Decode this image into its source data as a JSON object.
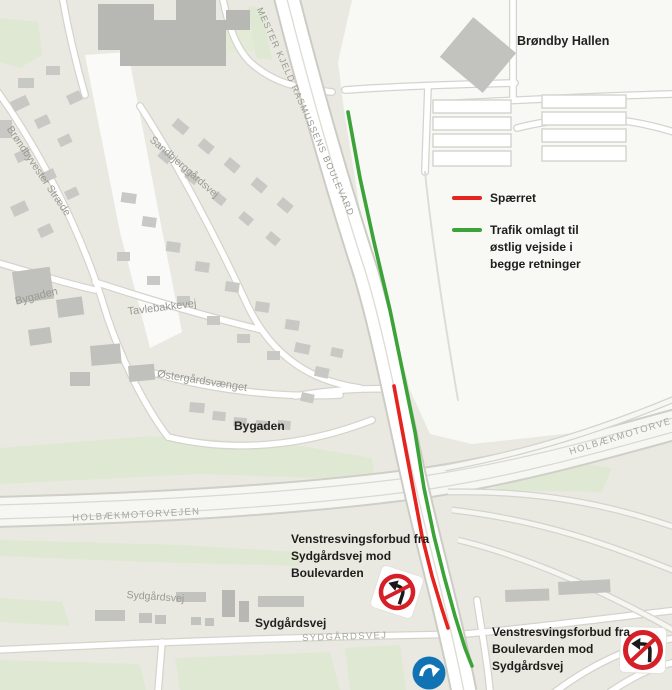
{
  "labels": {
    "brondby_hallen": "Brøndby Hallen",
    "boulevard": "MESTER KJELD RASMUSSENS BOULEVARD",
    "brondbyvester_straede": "Brøndbyvester Stræde",
    "sandbjerggardsvej": "Sandbjerggårdsvej",
    "bygaden_upper": "Bygaden",
    "tavlebakkevej": "Tavlebakkevej",
    "ostergardsvaenget": "Østergårdsvænget",
    "bygaden_lower": "Bygaden",
    "holbaekmotorvejen_left": "HOLBÆKMOTORVEJEN",
    "holbaekmotorvejen_right": "HOLBÆKMOTORVEJEN",
    "sydgardsvej_small": "Sydgårdsvej",
    "sydgardsvej_black": "Sydgårdsvej",
    "sydgardsvej_caps": "SYDGÅRDSVEJ"
  },
  "legend": {
    "spaerret": "Spærret",
    "omlagt": "Trafik omlagt til\nøstlig vejside i\nbegge retninger"
  },
  "annotations": {
    "no_left_from_sydgardsvej": "Venstresvingsforbud fra\nSydgårdsvej mod\nBoulevarden",
    "no_left_from_boulevarden": "Venstresvingsforbud fra\nBoulevarden mod\nSydgårdsvej"
  },
  "icons": {
    "no_left_turn_sign": "red circle prohibition sign with black left-turn arrow and red slash",
    "mandatory_direction_sign": "blue circle sign with white curved arrow"
  },
  "colors": {
    "closed_red": "#e5231f",
    "diverted_green": "#3ca338",
    "sign_red": "#d62027",
    "sign_blue": "#1273b4",
    "map_background": "#e9e9e1",
    "green_area": "#dfe8d2",
    "building_gray": "#c8c8c4"
  }
}
